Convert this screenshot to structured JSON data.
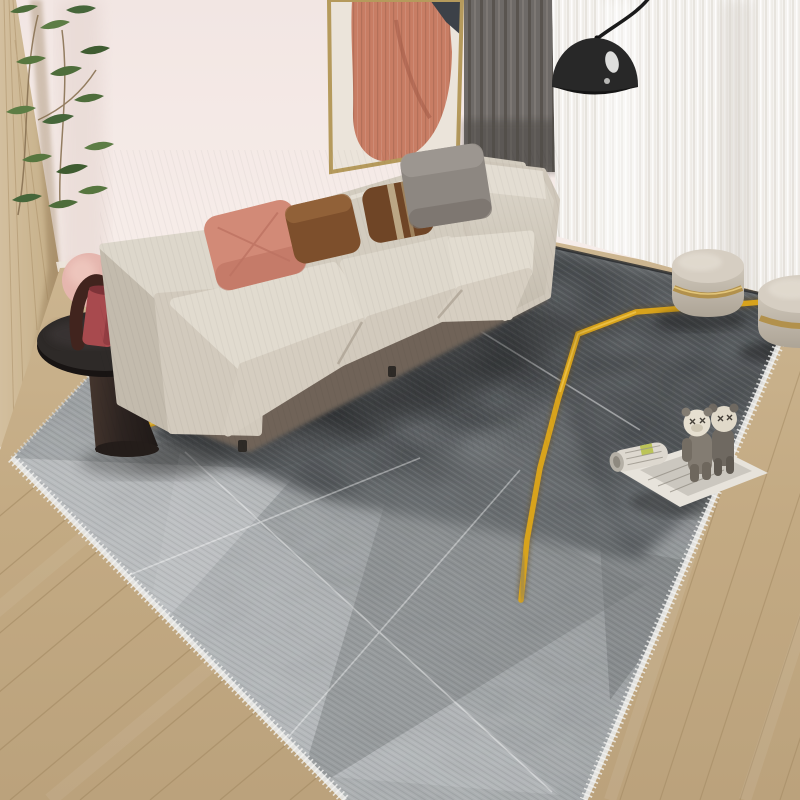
{
  "scene": {
    "type": "product-photo",
    "labels": {
      "root": "Modern living room with gray geometric area rug and gold zigzag accents",
      "wall": "Blush pink wall with wood side panel",
      "plant": "Green plant foliage in corner",
      "artwork": "Framed abstract terracotta artwork",
      "curtain_dark": "Gray drape panel",
      "curtain_sheer": "White sheer curtain",
      "lamp": "Black arc floor lamp",
      "floor": "Light oak plank floor",
      "rug": "Gray geometric area rug with gold zigzag lines and white fringe",
      "side_table": "Round black pedestal side table",
      "vase": "Sculptural vase set with pink disc and red vessel",
      "sofa": "Beige modular fabric sofa",
      "pillows": "Salmon, brown and gray accent pillows",
      "poufs": "Round velvet poufs with gold bands",
      "toy": "Two plush figures standing on an open magazine"
    },
    "palette": {
      "wall_pink": "#f4e9e6",
      "wood_wall": "#cdb795",
      "floor_tan": "#c6ae89",
      "art_terracotta": "#c87d64",
      "curtain_dark": "#6e6a67",
      "curtain_sheer": "#f4f2ef",
      "sofa_beige": "#d9d3c8",
      "pillow_salmon": "#d28a77",
      "pillow_brown": "#7d4f2c",
      "pillow_gray": "#8d8781",
      "rug_dark": "#33363a",
      "rug_light": "#b4b8ba",
      "rug_gold": "#d8a31c",
      "table_black": "#2b2624",
      "vase_red": "#a84a4e",
      "vase_pink": "#e5b6ae",
      "pouf_greige": "#cac2b5"
    }
  }
}
